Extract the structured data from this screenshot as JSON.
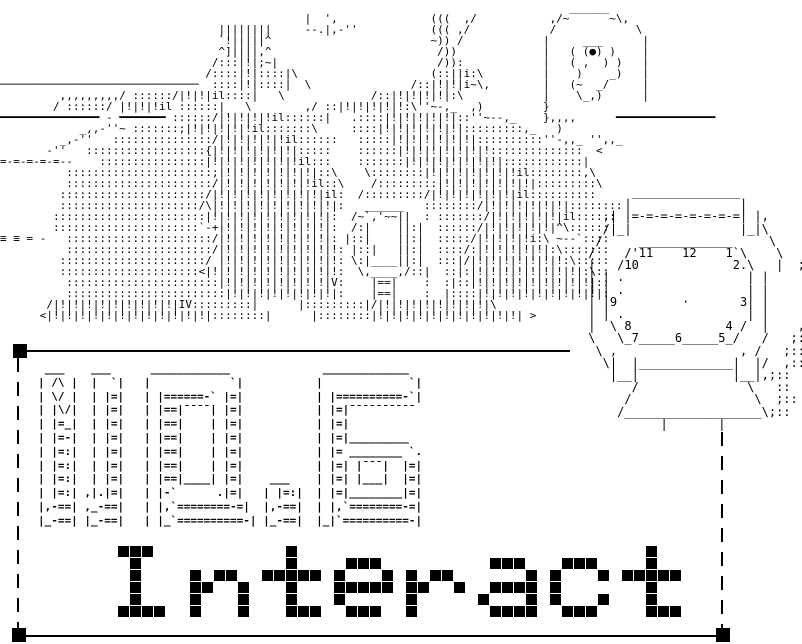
{
  "page": {
    "background": "#ffffff",
    "ink": "#000000"
  },
  "artwork": {
    "title": "NO.6",
    "caption": "Interact",
    "scene_lines": [
      "                                                                                      ______",
      "                                              |  ',              (((  ,/           ,/~      ~\\,",
      "                                 ||||||||     --.|,-''           ((( ,/            /            \\",
      "                                 `!|||||^                        ~)) /            |     ___      |",
      "                                 ^]||||,^                         /))             |   ( (●) )    |",
      "                                /:::|!|;~|                        /)):            |   ( ,  ) )   |",
      "                               /::::|!|::::|\\                    (::||i:\\         |    )    _)   |",
      "──────────────────────────────  ::::|!|::::|  \\               /::|!|!|i~\\,        |   (~  _/     |",
      "         ,,,,,,,,,/ ::::::/|!|!|il::::|   \\             /::|!|!|!|!|:\\            |    \\_,)      |",
      "        / ::::::/ |!|!|!il ::::::|   \\        ,/ ::|!|!|!|!|!:\\''~-,_  ,)         }",
      "━━━━━━━━━━━━━━━ - ━━━━━━━ ::::::/|!|!|!|!il::::::|   .::::|!|!|!|!|!|::''~--,_    },,,,      ━━━━━━━━━━━━━━━",
      "            _,,-''~ :::::::;|!|!|!|!|!il:::::::\\     ::::|!|!|!|!|!|!|:::::::::,_   )",
      "         _,-''   :::::::::::::::/|!|!|!|!|!il::::::   :::::|!|!|!|!|!|!|::::::::::''-,,_ '',,_",
      "       -''   ::::::::::::::::::{|!|!|!|!|!|!|:::::    ::::::|!|!|!|!|!|!|!::::::::::::::  <",
      "=-=-=-=-=--    ::::::::::::::::|!|!|!|!|!|!|!il:::    :::::::|!|!|!|!|!|!|!|::::::::::::|",
      "          ::::::::::::::::::::::;|!|!|!|!|!|!|!|::\\    \\::::::::|!|!|!|!|!|!|!il::::::::,\\",
      "          ::::::::::::::::::::::/|!|!|!|!|!|!|!il::\\    /:::::::::|!|!|!|!|!|!|!|:::::::::\\",
      "         ::::::::::::::::::::::/|!|!|!|!|!|!|!|!|il:  /:::::::::/|!|!|!|!|!|!|il::::::::::",
      "         :::::::::::::::::::::/\\|!|!|!|!|!|!|!|!|!|:   ______   ::::::::/|!|!|!|!|!|!|::::::::",
      "        :::::::::::::::::::::::|!|!|!|!|!|!|!|!|!|:  /~`,'~~||  : :::::::/|!|!|!|!|!|il::::::",
      "        ::::::::::::::::::::::`-+|!|!|!|!|!|!|!|!|:  /:|    ||:|  ::::::/|!|!|!|!|!|^\\::::::",
      "≡ ≡ = -   ::::::::::::::::::::::/|!|!|!|!|!|!|!|!|: |::|    ||:|  :::::/|!|!|!|!i:\\ ~--`::::",
      "          ::::::::::::::::::::::/|!|!|!|!|!|!|!|!|!: |::|   ||:|  ::::/:|!|!|!|!|!|:\\:::::::",
      "         ::::::::::::::::::::::/ |!|!|!|!|!|!|!|!|!: \\:|____||:|  :::|/|!|!|!|!|!|!|!:\\:::::",
      "         :::::::::::::::::::::<|!|!|!|!|!|!|!|!|!|!:  \\,____,/::|  ::|:|!|!|!|!|!|!|!|!|:\\::",
      "          :::::::::::::::::::::::|!|!|!|!|!|!|!|!|V:    |==|    :  :|::|!|!|!|!|!|!|!|!|!|::",
      "          ::::::::::::::::::::::::|!|!|!|!|!|!|!|!|:    |==|    :  |::::|!|!|!|!|!|!|!|!|!|:",
      "       /|!|!|!|!|!|!|!|!|!|IV:::::::::|      |:::::::::|/|!|!|!|!|!|!|!|!|\\",
      "      <|!|!|!|!|!|!|!|!|!|!|!|!|::::::::|      |::::::::|!|!|!|!|!|!|!|!|!|!|!| >",
      "",
      ""
    ],
    "clock": {
      "dial_numbers": [
        "12",
        "1",
        "2",
        "3",
        "4",
        "5",
        "6",
        "7",
        "8",
        "9",
        "10",
        "11"
      ],
      "lines": [
        "       _______________",
        "      |               |",
        "   ,| |=-=-=-=-=-=-=-=| |,",
        "   /|_|               |_|\\",
        "  /     _____________     \\",
        " /    /'11    12    1`\\    \\",
        " |   /10             2.\\   |  ;::",
        " | | .                 | |     ::",
        " | | .                 | |     ::",
        " | |9         ·       3| |     ::",
        " | | .                 | |     ::",
        " |  \\ 8             4 /  |    ,::",
        " \\   \\_7_____6_____5_/   /   ;::",
        "  \\ ,                 , /   ;::",
        "   \\|  |_____________|  |/  ,::",
        "    |__|             |__|,;::",
        "       /               \\   ::",
        "      /                 \\  ;::",
        "     /___________________\\;::",
        "           |       |"
      ]
    },
    "title_lines": [
      " ___    ___      ____________              _____________  ",
      "| /\\ |  |  `|   |            `|           |             `|",
      "| \\/ |  | |=|   | |======-` |=|           | |==========-`|",
      "| |\\/|  | |=|   | |==|¯¯¯¯| |=|           | |=|¯¯¯¯¯¯¯¯¯¯",
      "| |=_|  | |=|   | |==|    | |=|           | |=|",
      "| |=-|  | |=|   | |==|    | |=|           | |=|_________",
      "| |=:|  | |=|   | |==|    | |=|           | |= ________ `.",
      "| |=:|  | |=|   | |==|    | |=|           | |=| |¯¯¯|  |=|",
      "| |=:|  | |=|   | |==|____| |=|    ___    | |=| |___|  |=|",
      "| |=:| ,|.|=|   | |-`      .|=|   | |=:|  | |=|________|=|",
      "|,-==| ,_-==|   | |,`========-=|  |,-==|  | |,`========-=|",
      "|_-==| |_-==|   | |_`==========-| |_-==|  |_|`==========-|"
    ],
    "pixel_caption": {
      "text": "Interact",
      "letters": [
        {
          "char": "I",
          "bitmap": [
            "###..",
            ".#...",
            ".#...",
            ".#...",
            ".#...",
            "####."
          ]
        },
        {
          "char": "n",
          "bitmap": [
            ".....",
            ".....",
            "#.##.",
            "##..#",
            "#...#",
            "#...#"
          ]
        },
        {
          "char": "t",
          "bitmap": [
            "..#..",
            "..#..",
            "#####",
            "..#..",
            "..#..",
            "..###"
          ]
        },
        {
          "char": "e",
          "bitmap": [
            ".....",
            ".###.",
            "#...#",
            "#####",
            "#....",
            ".###."
          ]
        },
        {
          "char": "r",
          "bitmap": [
            ".....",
            ".....",
            "#.##.",
            "##..#",
            "#....",
            "#...."
          ]
        },
        {
          "char": "a",
          "bitmap": [
            ".....",
            ".###.",
            "....#",
            ".####",
            "#...#",
            ".####"
          ]
        },
        {
          "char": "c",
          "bitmap": [
            ".....",
            ".###.",
            "#...#",
            "#....",
            "#...#",
            ".###."
          ]
        },
        {
          "char": "t",
          "bitmap": [
            "..#..",
            "..#..",
            "#####",
            "..#..",
            "..#..",
            "..###"
          ]
        }
      ]
    },
    "selection_box": {
      "handle_color": "#000000",
      "handle_count": 3
    }
  }
}
